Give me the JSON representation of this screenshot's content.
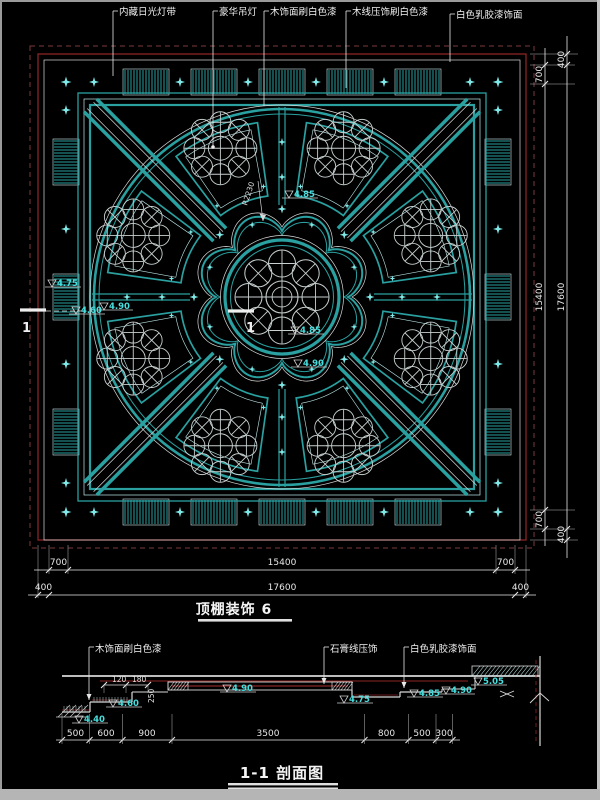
{
  "colors": {
    "background": "#000000",
    "teal": "#2aa0a0",
    "teal_bright": "#7fe9e9",
    "teal_pale": "#bfeaea",
    "white_line": "#d8d8d8",
    "red_line": "#8b2424",
    "red_bright": "#a83030",
    "cluster_line": "#c8d0d0",
    "cyan_text": "#49dede",
    "white_text": "#f0f0f0",
    "frame_grey": "#b5b5b5"
  },
  "plan": {
    "title": "顶棚装饰 6",
    "callouts": [
      "内藏日光灯带",
      "豪华吊灯",
      "木饰面刷白色漆",
      "木线压饰刷白色漆",
      "白色乳胶漆饰面"
    ],
    "radius_label": "R2230",
    "section_marker": "1",
    "elevations": [
      "4.85",
      "4.85",
      "4.90",
      "4.75",
      "4.60",
      "4.90"
    ],
    "dims_bottom_inner": [
      "700",
      "15400",
      "700"
    ],
    "dims_bottom_outer": [
      "400",
      "17600",
      "400"
    ],
    "dims_right_inner": [
      "700",
      "15400",
      "700"
    ],
    "dims_right_outer": [
      "400",
      "17600",
      "400"
    ]
  },
  "section": {
    "title": "1-1 剖面图",
    "callouts": [
      "木饰面刷白色漆",
      "石膏线压饰",
      "白色乳胶漆饰面"
    ],
    "dims_top": [
      "120",
      "180"
    ],
    "dim_side": "250",
    "elevations": [
      "4.40",
      "4.60",
      "4.90",
      "4.75",
      "4.85",
      "4.90",
      "5.05"
    ],
    "dims_bottom": [
      "500",
      "600",
      "900",
      "3500",
      "800",
      "500",
      "300"
    ]
  }
}
